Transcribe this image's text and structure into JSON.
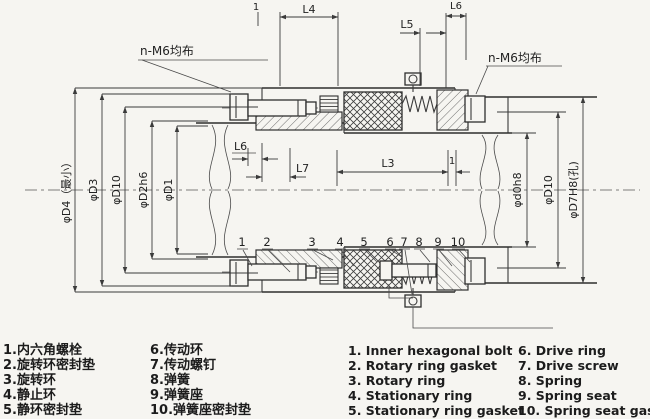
{
  "drawing": {
    "note_left": "n-M6均布",
    "note_right": "n-M6均布",
    "dim_l4": "L4",
    "dim_one_top": "1",
    "dim_l5": "L5",
    "dim_l6_top": "L6",
    "dim_l6_mid": "L6",
    "dim_l7": "L7",
    "dim_l3": "L3",
    "dim_one_mid": "1",
    "dia_left": [
      "φD4（最小）",
      "φD3",
      "φD10",
      "φD2h6",
      "φD1"
    ],
    "dia_right": [
      "φd0h8",
      "φD10",
      "φD7H8(孔)"
    ],
    "parts": [
      "1",
      "2",
      "3",
      "4",
      "5",
      "6",
      "7",
      "8",
      "9",
      "10"
    ]
  },
  "legend": {
    "zh": [
      "1.内六角螺栓",
      "2.旋转环密封垫",
      "3.旋转环",
      "4.静止环",
      "5.静环密封垫",
      "6.传动环",
      "7.传动螺钉",
      "8.弹簧",
      "9.弹簧座",
      "10.弹簧座密封垫"
    ],
    "en": [
      "1. Inner hexagonal bolt",
      "2. Rotary ring gasket",
      "3. Rotary ring",
      "4. Stationary ring",
      "5. Stationary ring gasket",
      "6. Drive ring",
      "7. Drive screw",
      "8. Spring",
      "9. Spring seat",
      "10. Spring seat gasket"
    ]
  }
}
